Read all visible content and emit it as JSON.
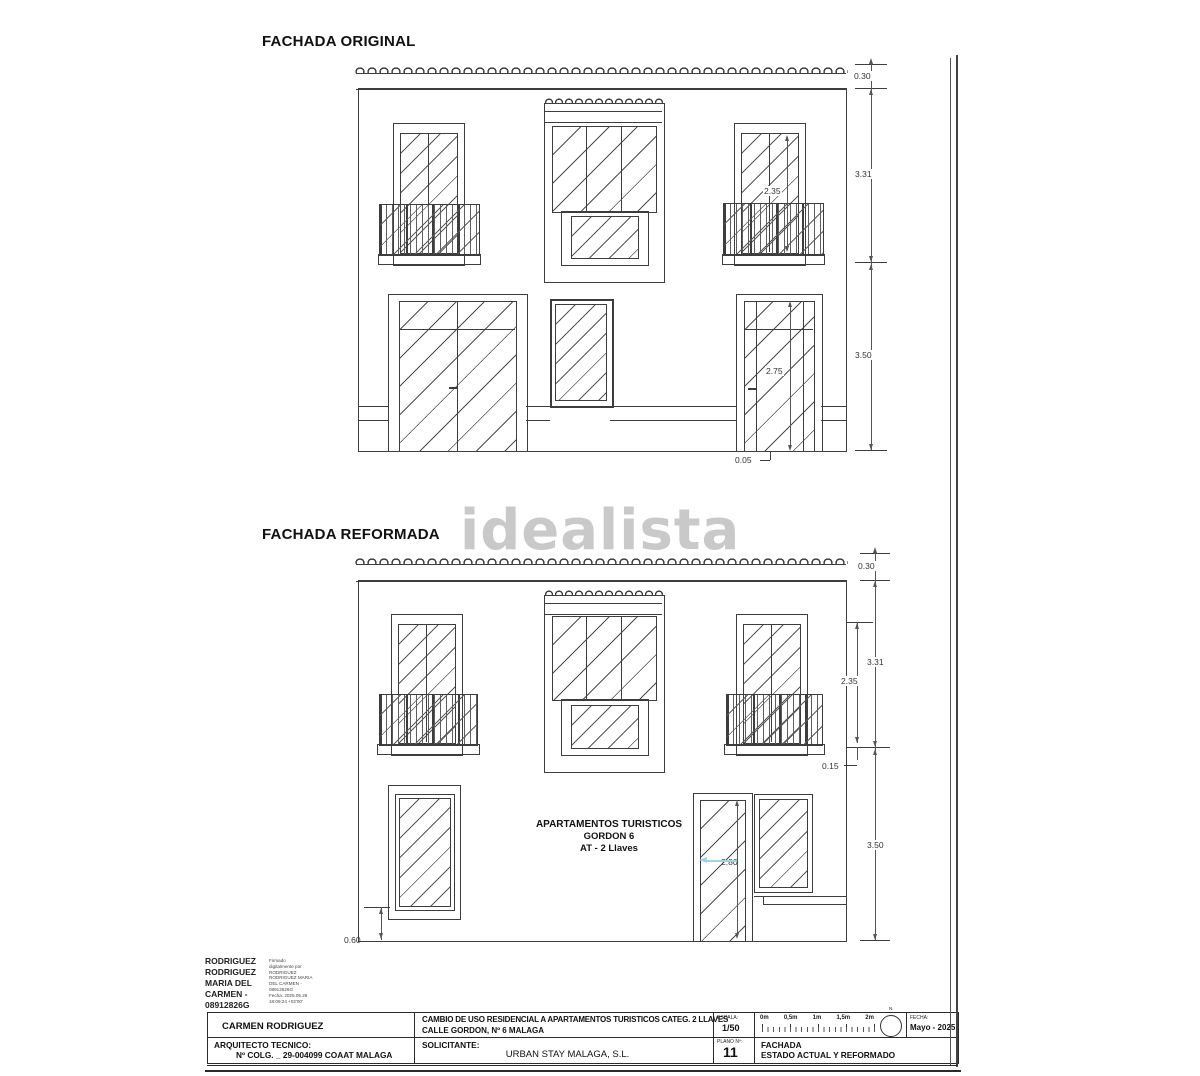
{
  "colors": {
    "line": "#3d3d3d",
    "watermark": "#c9c9c9",
    "arrow_blue": "#9fd4e4",
    "text": "#1c1c1c"
  },
  "watermark": {
    "text": "idealista"
  },
  "original": {
    "title": "FACHADA ORIGINAL",
    "dims": {
      "roof": "0.30",
      "upper": "3.31",
      "window": "2.35",
      "lower": "3.50",
      "door": "2.75",
      "threshold": "0.05"
    }
  },
  "reformed": {
    "title": "FACHADA REFORMADA",
    "label": {
      "line1": "APARTAMENTOS TURISTICOS",
      "line2": "GORDON 6",
      "line3": "AT - 2 Llaves"
    },
    "dims": {
      "roof": "0.30",
      "upper": "3.31",
      "window": "2.35",
      "sill": "0.15",
      "lower": "3.50",
      "door": "2.80",
      "plinth": "0.60"
    }
  },
  "signature": {
    "name_lines": [
      "RODRIGUEZ",
      "RODRIGUEZ",
      "MARIA DEL",
      "CARMEN -",
      "08912826G"
    ],
    "detail_lines": [
      "Firmado",
      "digitalmente por",
      "RODRIGUEZ",
      "RODRIGUEZ MARIA",
      "DEL CARMEN -",
      "08912826G",
      "Fecha: 2025.05.29",
      "18:09:24 +02'00'"
    ]
  },
  "titleblock": {
    "author": "CARMEN RODRIGUEZ",
    "role_label": "ARQUITECTO TECNICO:",
    "role_value": "Nº COLG. _ 29-004099  COAAT MALAGA",
    "project_line1": "CAMBIO DE USO RESIDENCIAL A APARTAMENTOS TURISTICOS CATEG. 2 LLAVES",
    "project_line2": "CALLE GORDON, Nº 6  MALAGA",
    "applicant_label": "SOLICITANTE:",
    "applicant_value": "URBAN STAY MALAGA, S.L.",
    "scale_label": "ESCALA:",
    "scale_value": "1/50",
    "scalebar_labels": [
      "0m",
      "0,5m",
      "1m",
      "1,5m",
      "2m"
    ],
    "north_label": "N.",
    "date_label": "FECHA:",
    "date_value": "Mayo - 2025",
    "plan_label": "PLANO Nº:",
    "plan_value": "11",
    "sheet_title_line1": "FACHADA",
    "sheet_title_line2": "ESTADO ACTUAL Y REFORMADO"
  }
}
